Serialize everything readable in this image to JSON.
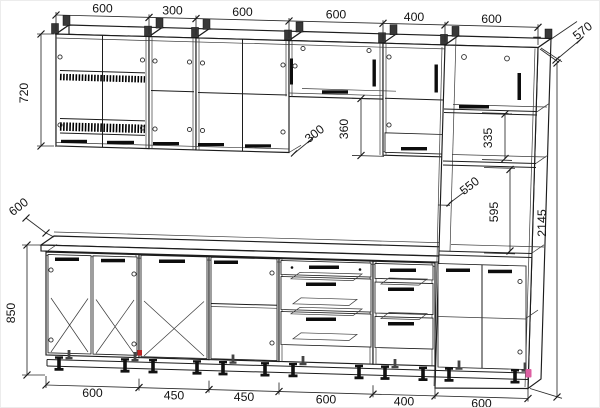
{
  "drawing": {
    "kind": "kitchen-cabinet-elevation-technical-drawing",
    "units": "mm"
  },
  "dims": {
    "top": [
      "600",
      "300",
      "600",
      "600",
      "400",
      "600"
    ],
    "bottom": [
      "600",
      "450",
      "450",
      "600",
      "400",
      "600"
    ],
    "wall_height": "720",
    "counter_depth": "600",
    "base_height": "850",
    "wall_depth": "300",
    "gap_360": "360",
    "column_depth": "570",
    "niche_335": "335",
    "niche_550": "550",
    "niche_595": "595",
    "total_height": "2145"
  },
  "colors": {
    "line": "#1c1c1c",
    "background": "#ffffff",
    "marker_pink": "#dd5fa2",
    "marker_red": "#bb2222"
  }
}
